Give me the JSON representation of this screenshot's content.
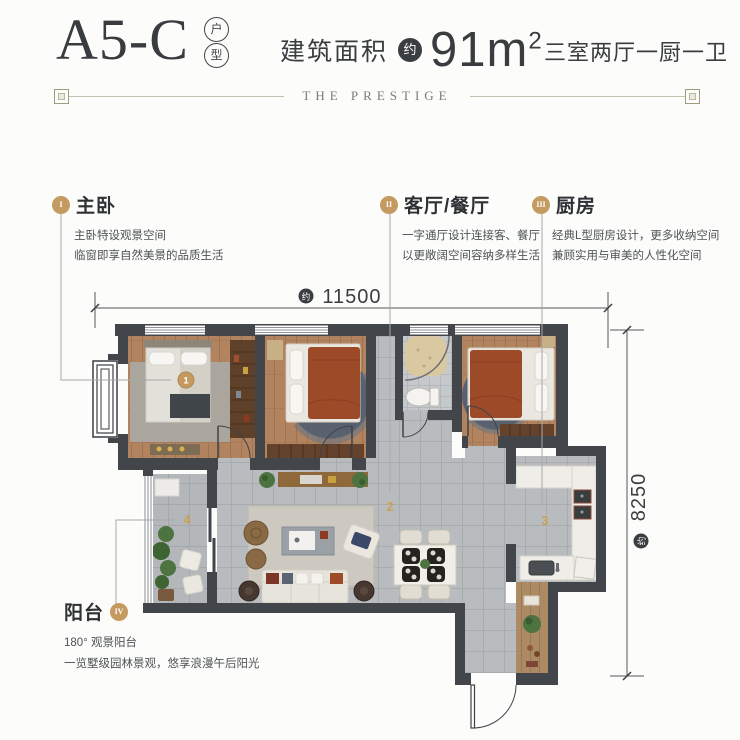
{
  "header": {
    "unit_code": "A5-C",
    "unit_type_chars": [
      "户",
      "型"
    ],
    "area_label": "建筑面积",
    "approx_label": "约",
    "area_value": "91m",
    "area_exponent": "2",
    "rooms_label": "三室两厅一厨一卫",
    "divider_text": "THE PRESTIGE"
  },
  "annotations": [
    {
      "numeral": "I",
      "title": "主卧",
      "lines": [
        "主卧特设观景空间",
        "临窗即享自然美景的品质生活"
      ]
    },
    {
      "numeral": "II",
      "title": "客厅/餐厅",
      "lines": [
        "一字通厅设计连接客、餐厅",
        "以更敞阔空间容纳多样生活"
      ]
    },
    {
      "numeral": "III",
      "title": "厨房",
      "lines": [
        "经典L型厨房设计，更多收纳空间",
        "兼顾实用与审美的人性化空间"
      ]
    },
    {
      "numeral": "IV",
      "title": "阳台",
      "lines": [
        "180°  观景阳台",
        "一览墅级园林景观，悠享浪漫午后阳光"
      ]
    }
  ],
  "dimensions": {
    "width": {
      "value": "11500",
      "approx": "约"
    },
    "height": {
      "value": "8250",
      "approx": "约"
    }
  },
  "plan": {
    "markers": [
      "1",
      "2",
      "3",
      "4"
    ]
  },
  "colors": {
    "gold": "#c49a61",
    "wall": "#42464a",
    "text_dark": "#34383b"
  }
}
